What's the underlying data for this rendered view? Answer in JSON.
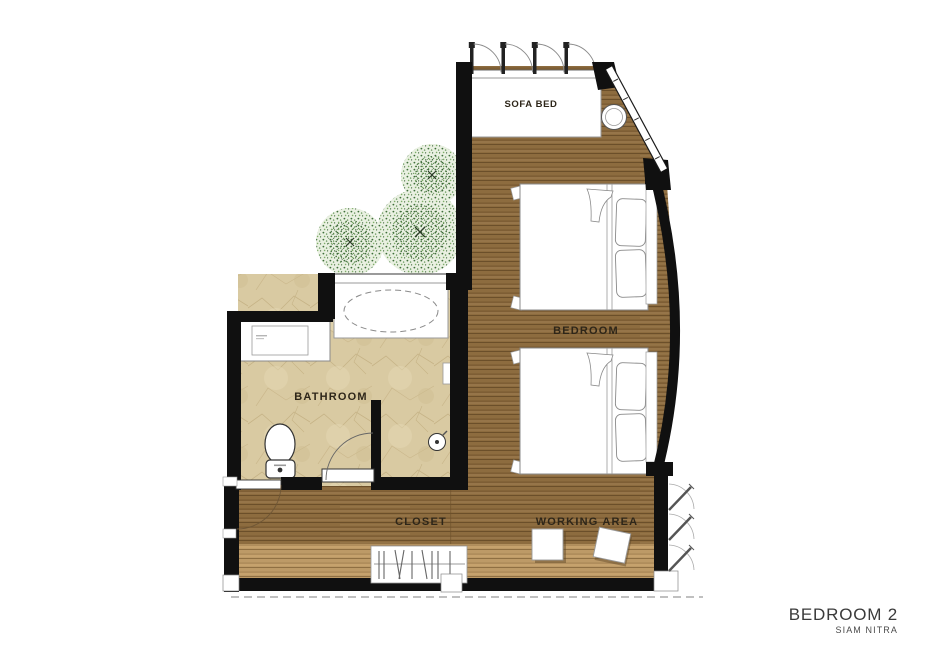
{
  "plan": {
    "labels": {
      "sofa_bed": "SOFA BED",
      "bedroom": "BEDROOM",
      "bathroom": "BATHROOM",
      "closet": "CLOSET",
      "working_area": "WORKING AREA"
    },
    "title": "BEDROOM 2",
    "subtitle": "SIAM NITRA",
    "colors": {
      "wall": "#111111",
      "wood_floor": "#8b6a3d",
      "light_wood": "#bd9a67",
      "bathroom_tile": "#d9caa2",
      "tree_green": "#6d9c5d",
      "background": "#ffffff"
    }
  }
}
